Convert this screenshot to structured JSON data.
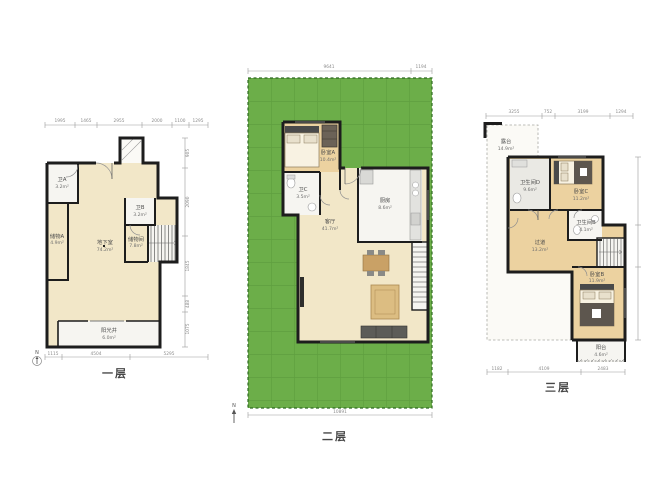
{
  "page": {
    "background": "#ffffff"
  },
  "colors": {
    "wall": "#1d1d1d",
    "cream": "#f2e7c8",
    "tan": "#ecd2a0",
    "white_room": "#f6f5f1",
    "gray_room": "#eae9e4",
    "lawn": "#6cae49",
    "lawn_grid": "#5f9f3f",
    "lawn_border": "#2f6b22",
    "dim_line": "#9a9a9a",
    "wood": "#c9a166"
  },
  "floor1": {
    "label": "一层",
    "compass": "N",
    "dims_top": [
      "1995",
      "1465",
      "2955",
      "2000",
      "1100",
      "1295"
    ],
    "dims_bottom": [
      "1115",
      "4504",
      "5295"
    ],
    "dims_right": [
      "905",
      "2090",
      "1845",
      "488",
      "1075"
    ],
    "rooms": {
      "bath_a": {
        "name": "卫A",
        "area": "3.2m²"
      },
      "storage_a": {
        "name": "储物A",
        "area": "4.9m²"
      },
      "basement": {
        "name": "地下室",
        "area": "74.2m²"
      },
      "bath_b": {
        "name": "卫B",
        "area": "3.2m²"
      },
      "storage": {
        "name": "储物间",
        "area": "7.8m²"
      },
      "sunwell": {
        "name": "阳光井",
        "area": "6.0m²"
      }
    }
  },
  "floor2": {
    "label": "二层",
    "compass": "N",
    "dims_top": [
      "9641",
      "1194"
    ],
    "dims_bottom": [
      "10891"
    ],
    "rooms": {
      "bedroom_a": {
        "name": "卧室A",
        "area": "10.4m²"
      },
      "bath_c": {
        "name": "卫C",
        "area": "3.5m²"
      },
      "kitchen": {
        "name": "厨房",
        "area": "8.6m²"
      },
      "living": {
        "name": "客厅",
        "area": "41.7m²"
      }
    }
  },
  "floor3": {
    "label": "三层",
    "dims_top": [
      "3255",
      "752",
      "3199",
      "1294"
    ],
    "dims_bottom": [
      "1182",
      "4109",
      "2483"
    ],
    "rooms": {
      "terrace": {
        "name": "露台",
        "area": "14.9m²"
      },
      "bath_d": {
        "name": "卫生间D",
        "area": "9.6m²"
      },
      "bedroom_c": {
        "name": "卧室C",
        "area": "11.2m²"
      },
      "bath_b": {
        "name": "卫生间B",
        "area": "4.1m²"
      },
      "hall": {
        "name": "过道",
        "area": "13.2m²"
      },
      "bedroom_b": {
        "name": "卧室B",
        "area": "11.9m²"
      },
      "balcony": {
        "name": "阳台",
        "area": "4.6m²"
      }
    }
  }
}
